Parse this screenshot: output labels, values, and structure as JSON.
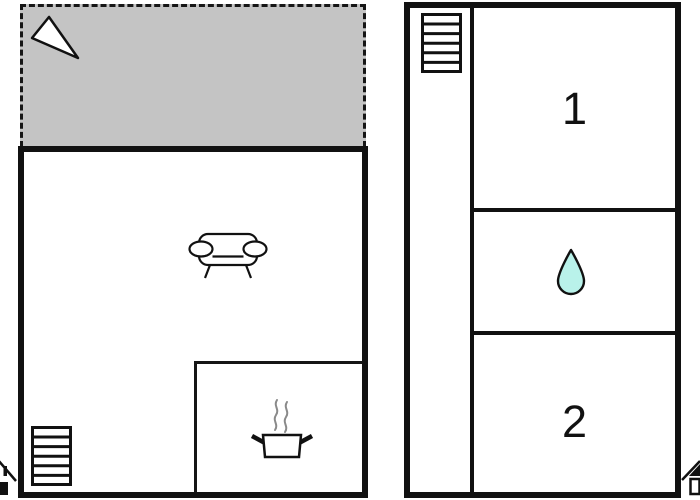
{
  "plan": {
    "type": "floor-plan",
    "labels": {
      "room1": "1",
      "room2": "2"
    },
    "left_unit": {
      "areas": [
        "terrace",
        "living-room",
        "kitchen"
      ],
      "icons": [
        "north-arrow",
        "sofa",
        "cooking-pot-with-steam",
        "staircase",
        "house-marker"
      ]
    },
    "right_unit": {
      "areas": [
        "stair-corridor",
        "room-1",
        "bathroom",
        "room-2"
      ],
      "icons": [
        "staircase",
        "water-drop",
        "house-marker"
      ]
    }
  },
  "icons": {
    "north_arrow": "white triangle pointer in terrace",
    "sofa": "two-seat sofa outline, top view",
    "cooking_pot": "pot with two handles and rising steam",
    "staircase": "rectangle with six treads",
    "water_drop": "teardrop, bathroom symbol",
    "house_marker": "small house glyph clipped at image edge"
  },
  "colors": {
    "wall": "#111111",
    "terrace_fill": "#c4c4c4",
    "drop_fill": "#b9f2ea",
    "steam": "#8a8a8a",
    "background": "#ffffff"
  }
}
